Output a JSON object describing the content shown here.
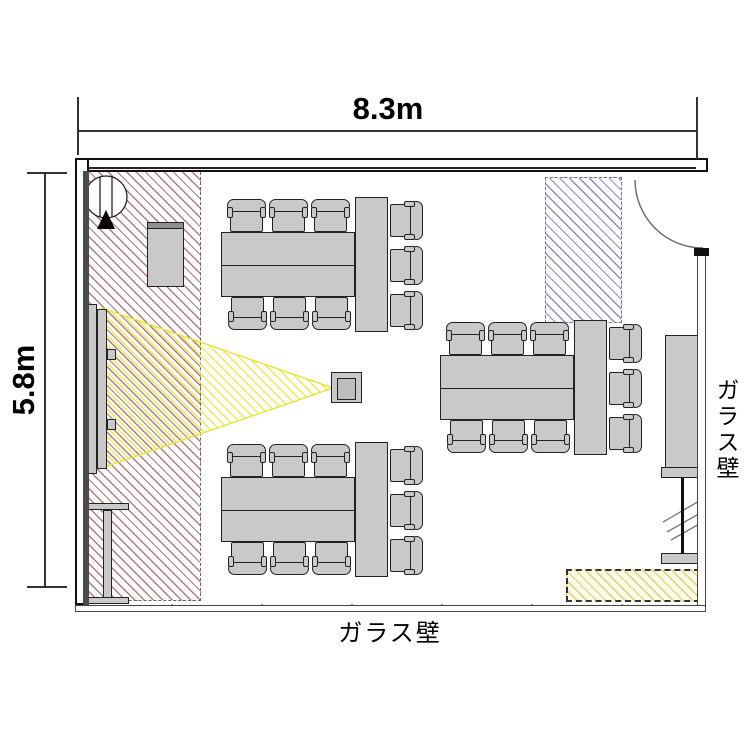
{
  "labels": {
    "width_dim": "8.3m",
    "height_dim": "5.8m",
    "glass_wall_right": "ガラス壁",
    "glass_wall_bottom": "ガラス壁"
  },
  "room": {
    "width_m": 8.3,
    "height_m": 5.8
  },
  "colors": {
    "hatch_red": "#b5777d",
    "hatch_blue": "#8c8cc0",
    "beam_yellow": "#efe63c",
    "zone_yellow_line": "#d6d472",
    "zone_yellow_bg": "#fbfae9",
    "furniture_gray": "#c9c9c9",
    "wall_black": "#111111"
  },
  "plan": {
    "groups": [
      {
        "name": "meeting-table-group-top-left",
        "x": 221,
        "y": 232
      },
      {
        "name": "meeting-table-group-bottom-left",
        "x": 221,
        "y": 477
      },
      {
        "name": "meeting-table-group-right",
        "x": 440,
        "y": 355
      }
    ],
    "rects": [
      {
        "name": "cabinet-top-left",
        "cls": "furn",
        "x": 147,
        "y": 222,
        "w": 37,
        "h": 65
      },
      {
        "name": "cabinet-top-left-strip",
        "cls": "furn-dark",
        "x": 147,
        "y": 222,
        "w": 37,
        "h": 7
      },
      {
        "name": "projection-screen-bar-outer",
        "cls": "furn",
        "x": 88,
        "y": 304,
        "w": 9,
        "h": 170
      },
      {
        "name": "projection-screen-bar-inner",
        "cls": "furn",
        "x": 97,
        "y": 309,
        "w": 10,
        "h": 160
      },
      {
        "name": "screen-bracket-upper",
        "cls": "furn",
        "x": 107,
        "y": 349,
        "w": 9,
        "h": 11
      },
      {
        "name": "screen-bracket-lower",
        "cls": "furn",
        "x": 107,
        "y": 419,
        "w": 9,
        "h": 11
      },
      {
        "name": "projector-body",
        "cls": "furn",
        "x": 331,
        "y": 372,
        "w": 31,
        "h": 31
      },
      {
        "name": "projector-lens",
        "cls": "furn-inner",
        "x": 337,
        "y": 378,
        "w": 19,
        "h": 22
      },
      {
        "name": "side-table-top",
        "cls": "furn",
        "x": 85,
        "y": 503,
        "w": 44,
        "h": 7
      },
      {
        "name": "side-table-stem",
        "cls": "furn",
        "x": 103,
        "y": 510,
        "w": 9,
        "h": 88
      },
      {
        "name": "side-table-base",
        "cls": "furn",
        "x": 83,
        "y": 597,
        "w": 46,
        "h": 7
      },
      {
        "name": "cabinet-right",
        "cls": "furn",
        "x": 665,
        "y": 335,
        "w": 35,
        "h": 142
      },
      {
        "name": "partition-foot-upper",
        "cls": "furn",
        "x": 661,
        "y": 467,
        "w": 41,
        "h": 11
      },
      {
        "name": "partition-foot-lower",
        "cls": "furn",
        "x": 661,
        "y": 553,
        "w": 41,
        "h": 11
      },
      {
        "name": "partition-pole",
        "cls": "solid-dark",
        "x": 681,
        "y": 478,
        "w": 3,
        "h": 76
      }
    ],
    "tables": {
      "main_w": 134,
      "main_h": 65,
      "end_w": 33,
      "end_h": 135
    },
    "chairs_per_group": 9
  }
}
